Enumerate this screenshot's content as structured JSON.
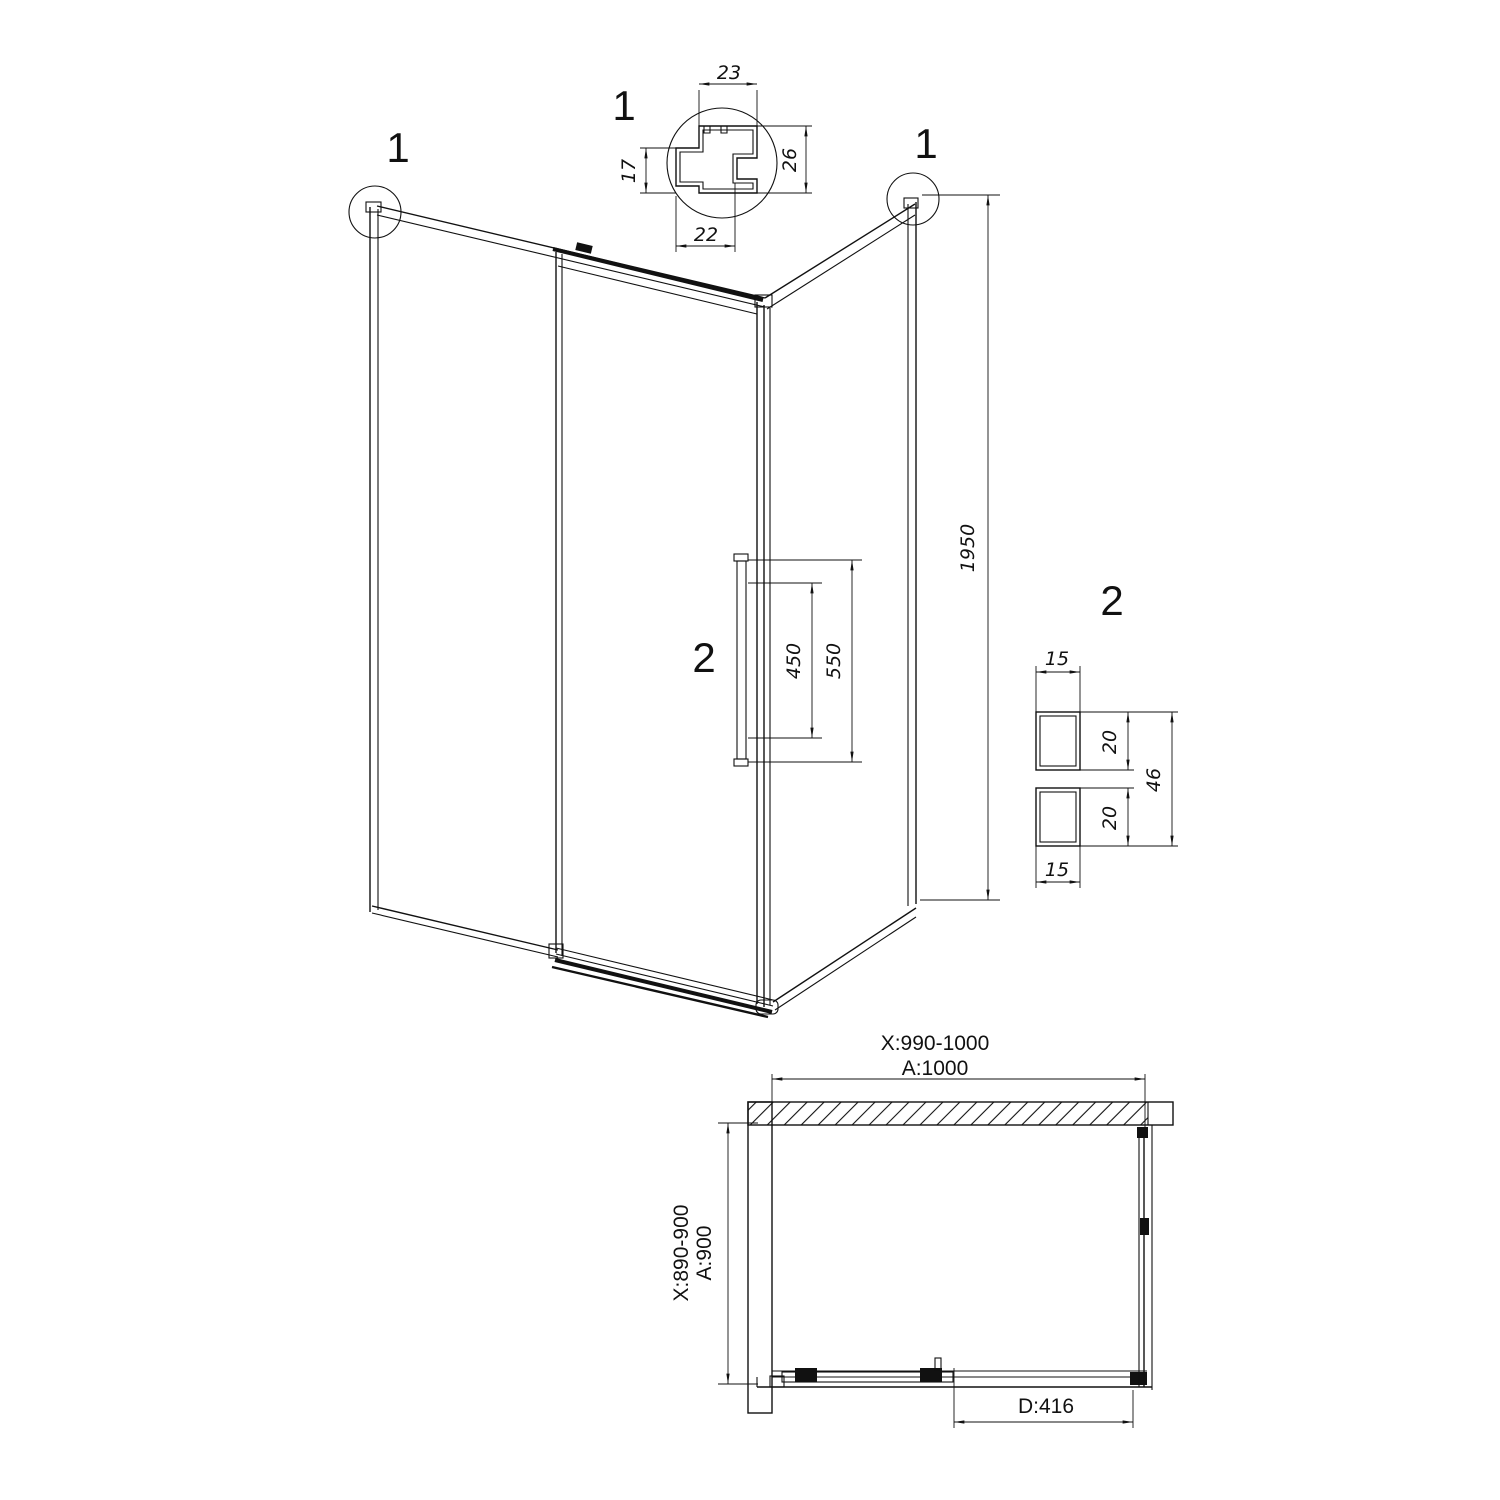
{
  "profile_detail": {
    "label": "1",
    "top_width": "23",
    "left_height": "17",
    "right_height": "26",
    "bottom_width": "22"
  },
  "isometric": {
    "corner_callout_left": "1",
    "corner_callout_right": "1",
    "height": "1950",
    "handle_callout": "2",
    "handle_inner_length": "450",
    "handle_outer_length": "550"
  },
  "handle_detail": {
    "label": "2",
    "top_width": "15",
    "upper_height": "20",
    "lower_height": "20",
    "overall_height": "46",
    "bottom_width": "15"
  },
  "plan": {
    "width_adjust_range": "X:990-1000",
    "width": "A:1000",
    "depth_adjust_range": "X:890-900",
    "depth": "A:900",
    "door_opening": "D:416"
  }
}
